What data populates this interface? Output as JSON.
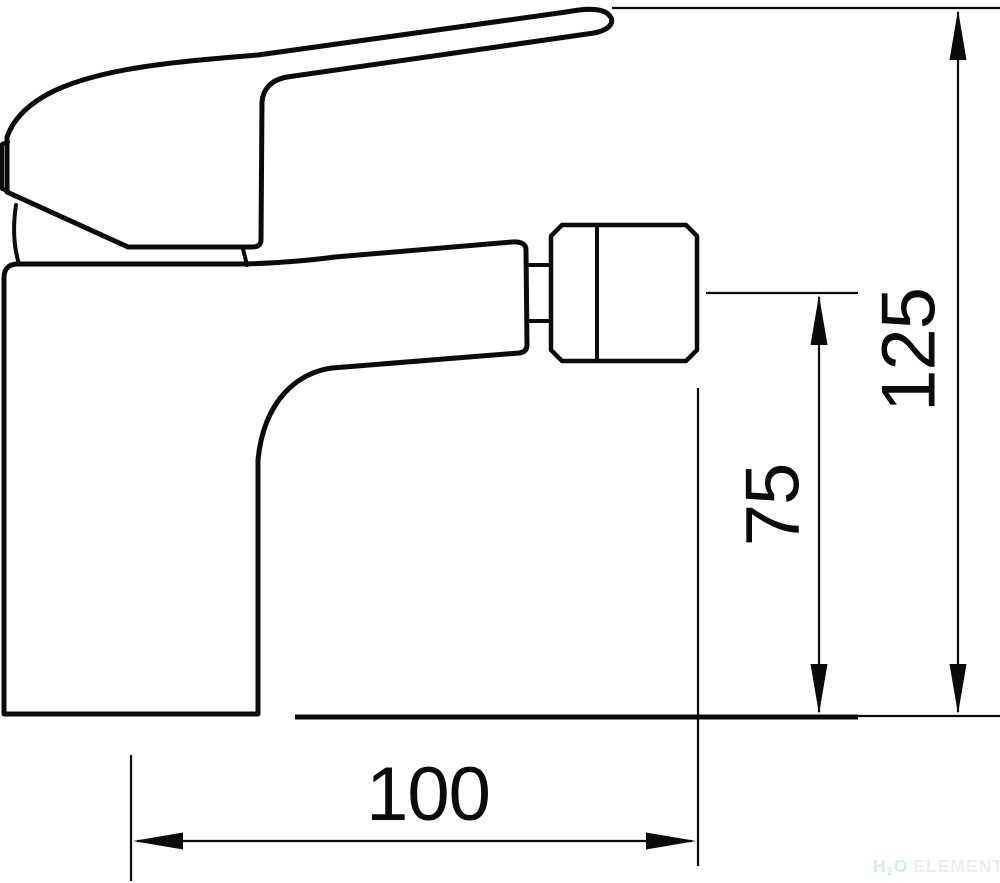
{
  "drawing": {
    "title": "Single-lever bidet mixer faucet — side view technical drawing",
    "type": "technical-dimension-drawing",
    "dimensions": {
      "overall_height": {
        "value": "125",
        "orientation": "vertical",
        "location": "right edge, lever top to mounting surface"
      },
      "spout_height": {
        "value": "75",
        "orientation": "vertical",
        "location": "aerator centerline to mounting surface"
      },
      "base_depth": {
        "value": "100",
        "orientation": "horizontal",
        "location": "body front to aerator tip"
      }
    },
    "watermark": {
      "h": "H",
      "sub": "2",
      "o": "O",
      "brand": "ELEMENT"
    },
    "colors": {
      "line": "#0b0b0b",
      "background": "#ffffff",
      "watermark_h2o": "#d7e9f3",
      "watermark_brand": "#ebedf0"
    }
  }
}
